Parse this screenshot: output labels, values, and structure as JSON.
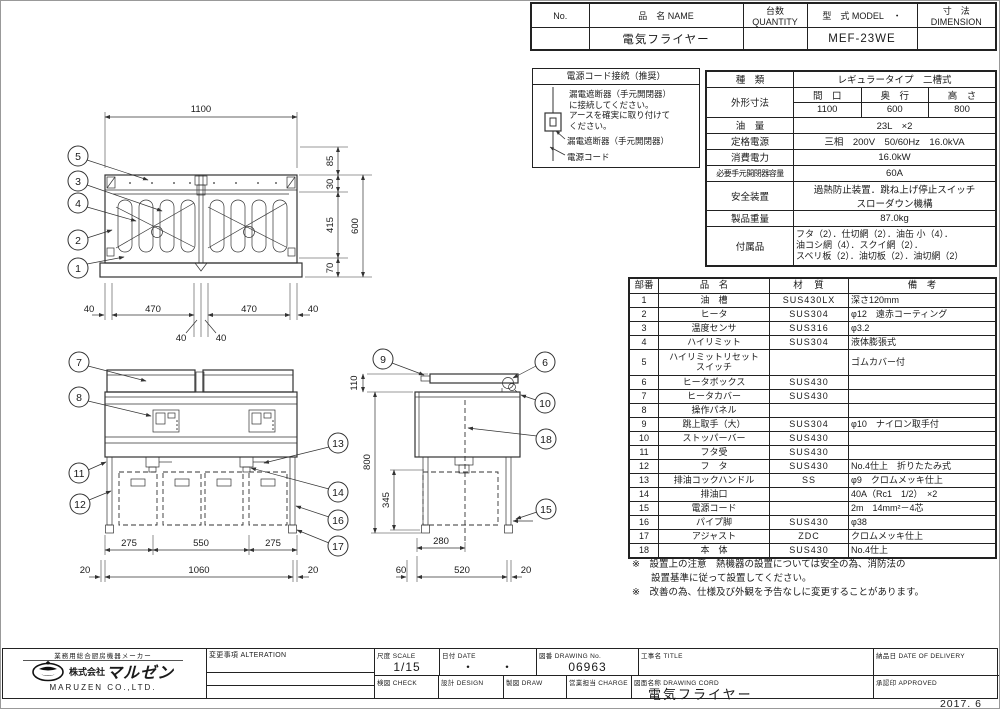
{
  "sheet": {
    "year_mark": "2017. 6"
  },
  "header_table": {
    "col_no": "No.",
    "col_name": "品　名 NAME",
    "col_qty": "台数 QUANTITY",
    "col_model": "型　式 MODEL　・",
    "col_dim": "寸　法 DIMENSION",
    "name_value": "電気フライヤー",
    "qty_value": "",
    "model_value": "MEF-23WE",
    "dim_value": ""
  },
  "power_box": {
    "title": "電源コード接続（推奨）",
    "instruction": "漏電遮断器（手元開閉器）\nに接続してください。\nアースを確実に取り付けて\nください。",
    "label_breaker": "漏電遮断器（手元開閉器）",
    "label_cord": "電源コード"
  },
  "spec_table": {
    "type_label": "種　類",
    "type_value": "レギュラータイプ　二槽式",
    "dims_label": "外形寸法",
    "dims_cols": [
      "間　口",
      "奥　行",
      "高　さ"
    ],
    "dims_vals": [
      "1100",
      "600",
      "800"
    ],
    "rows": [
      {
        "label": "油　量",
        "value": "23L　×2"
      },
      {
        "label": "定格電源",
        "value": "三相　200V　50/60Hz　16.0kVA"
      },
      {
        "label": "消費電力",
        "value": "16.0kW"
      },
      {
        "label": "必要手元開閉器容量",
        "value": "60A"
      },
      {
        "label": "安全装置",
        "value": "過熱防止装置．跳ね上げ停止スイッチ\nスローダウン機構"
      },
      {
        "label": "製品重量",
        "value": "87.0kg"
      },
      {
        "label": "付属品",
        "value": "フタ（2）．仕切網（2）．油缶 小（4）．\n油コシ網（4）．スクイ網（2）．\nスベリ板（2）．油切板（2）．油切網（2）"
      }
    ]
  },
  "parts_table": {
    "headers": [
      "部番",
      "品　名",
      "材　質",
      "備　考"
    ],
    "rows": [
      [
        "1",
        "油　槽",
        "SUS430LX",
        "深さ120mm"
      ],
      [
        "2",
        "ヒータ",
        "SUS304",
        "φ12　遠赤コーティング"
      ],
      [
        "3",
        "温度センサ",
        "SUS316",
        "φ3.2"
      ],
      [
        "4",
        "ハイリミット",
        "SUS304",
        "液体膨張式"
      ],
      [
        "5",
        "ハイリミットリセット\nスイッチ",
        "",
        "ゴムカバー付"
      ],
      [
        "6",
        "ヒータボックス",
        "SUS430",
        ""
      ],
      [
        "7",
        "ヒータカバー",
        "SUS430",
        ""
      ],
      [
        "8",
        "操作パネル",
        "",
        ""
      ],
      [
        "9",
        "跳上取手（大）",
        "SUS304",
        "φ10　ナイロン取手付"
      ],
      [
        "10",
        "ストッパーバー",
        "SUS430",
        ""
      ],
      [
        "11",
        "フタ受",
        "SUS430",
        ""
      ],
      [
        "12",
        "フ　タ",
        "SUS430",
        "No.4仕上　折りたたみ式"
      ],
      [
        "13",
        "排油コックハンドル",
        "SS",
        "φ9　クロムメッキ仕上"
      ],
      [
        "14",
        "排油口",
        "",
        "40A（Rc1　1/2）　×2"
      ],
      [
        "15",
        "電源コード",
        "",
        "2m　14mm²－4芯"
      ],
      [
        "16",
        "パイプ脚",
        "SUS430",
        "φ38"
      ],
      [
        "17",
        "アジャスト",
        "ZDC",
        "クロムメッキ仕上"
      ],
      [
        "18",
        "本　体",
        "SUS430",
        "No.4仕上"
      ]
    ]
  },
  "notes": {
    "note1": "※　設置上の注意　熱機器の設置については安全の為、消防法の\n　　設置基準に従って設置してください。",
    "note2": "※　改善の為、仕様及び外観を予告なしに変更することがあります。"
  },
  "title_block": {
    "alteration": "変更事項 ALTERATION",
    "scale_label": "尺度 SCALE",
    "scale_value": "1/15",
    "date_label": "日付 DATE",
    "date_value": "・　　・",
    "dwg_no_label": "図番 DRAWING No.",
    "dwg_no_value": "06963",
    "title_label": "工事名 TITLE",
    "delivery_label": "納品日 DATE OF DELIVERY",
    "check_label": "検図 CHECK",
    "design_label": "設計 DESIGN",
    "draw_label": "製図 DRAW",
    "charge_label": "営業担当 CHARGE",
    "dwg_name_label": "図面名称 DRAWING CORD",
    "dwg_name_value": "電気フライヤー",
    "approved_label": "承認印 APPROVED"
  },
  "company": {
    "tagline": "業務用総合厨房機器メーカー",
    "name_jp": "マルゼン",
    "kk": "株式会社",
    "name_en": "MARUZEN  CO.,LTD."
  },
  "drawing": {
    "balloons": [
      "1",
      "2",
      "3",
      "4",
      "5",
      "6",
      "7",
      "8",
      "9",
      "10",
      "11",
      "12",
      "13",
      "14",
      "15",
      "16",
      "17",
      "18"
    ],
    "plan": {
      "w": "1100",
      "r": [
        "85",
        "30",
        "415",
        "70",
        "600"
      ],
      "b": [
        "40",
        "470",
        "470",
        "40",
        "40",
        "40"
      ]
    },
    "front": {
      "b": [
        "275",
        "550",
        "275",
        "20",
        "1060",
        "20"
      ]
    },
    "side": {
      "v": [
        "110",
        "800",
        "345"
      ],
      "b": [
        "280",
        "60",
        "520",
        "20"
      ]
    }
  }
}
